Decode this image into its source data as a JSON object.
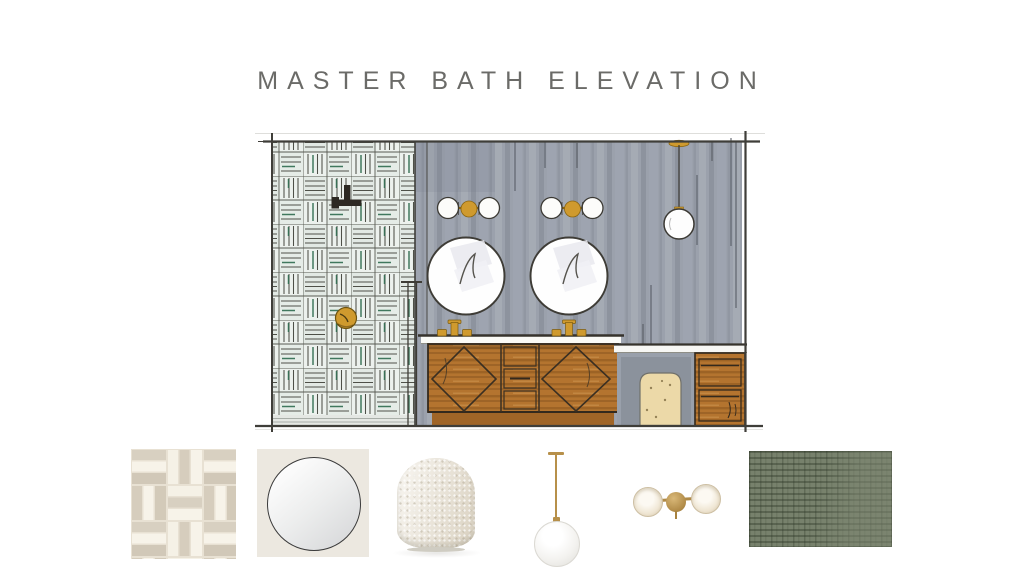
{
  "page": {
    "title": "MASTER BATH ELEVATION",
    "title_color": "#6b6b68",
    "background_color": "#ffffff"
  },
  "elevation": {
    "type": "hand-drawn interior elevation sketch",
    "items": [
      {
        "name": "tiled-shower-wall",
        "description": "basketweave tile wall with green accent strokes"
      },
      {
        "name": "shower-head",
        "description": "dark wall-mounted shower head"
      },
      {
        "name": "shower-control",
        "description": "round brass shower valve"
      },
      {
        "name": "shower-glass-panel",
        "description": "glass partition at shower edge"
      },
      {
        "name": "wall-sconce-left",
        "description": "two white globes with brass center"
      },
      {
        "name": "wall-sconce-right",
        "description": "two white globes with brass center"
      },
      {
        "name": "round-mirror-left",
        "description": "round mirror over left sink"
      },
      {
        "name": "round-mirror-right",
        "description": "round mirror over right sink"
      },
      {
        "name": "globe-pendant",
        "description": "white globe pendant on brass stem"
      },
      {
        "name": "double-vanity",
        "description": "wood vanity with diamond-front doors, center drawers and two brass faucets"
      },
      {
        "name": "makeup-counter",
        "description": "lower counter with knee space"
      },
      {
        "name": "pouf-under-counter",
        "description": "beige speckled pouf"
      },
      {
        "name": "drawer-cabinet-right",
        "description": "wood two-drawer cabinet"
      }
    ],
    "colors": {
      "wall_gray": "#9ba1ac",
      "tile_background": "#ecf1ed",
      "tile_line": "#4e5048",
      "tile_accent_green": "#2e6b4f",
      "wood_brown": "#b4742f",
      "brass": "#cf9a2e",
      "sketch_outline": "#3e3c36",
      "pouf_beige": "#ecd9a8"
    }
  },
  "products": [
    {
      "name": "basketweave-tile-swatch",
      "colors": {
        "cream": "#f7f3e9",
        "taupe": "#d6cdbd"
      }
    },
    {
      "name": "round-thin-frame-mirror",
      "colors": {
        "card": "#ece8e0",
        "frame": "#3b3b3b"
      }
    },
    {
      "name": "cream-boucle-pouf",
      "colors": {
        "fabric": "#efe9dc"
      }
    },
    {
      "name": "brass-globe-pendant-light",
      "colors": {
        "brass": "#b7904a",
        "globe": "#f3f2ef"
      }
    },
    {
      "name": "brass-double-globe-sconce",
      "colors": {
        "brass": "#b08a47",
        "globe": "#f0e7d5"
      }
    },
    {
      "name": "green-textured-rug-swatch",
      "colors": {
        "green": "#77816c"
      }
    }
  ]
}
